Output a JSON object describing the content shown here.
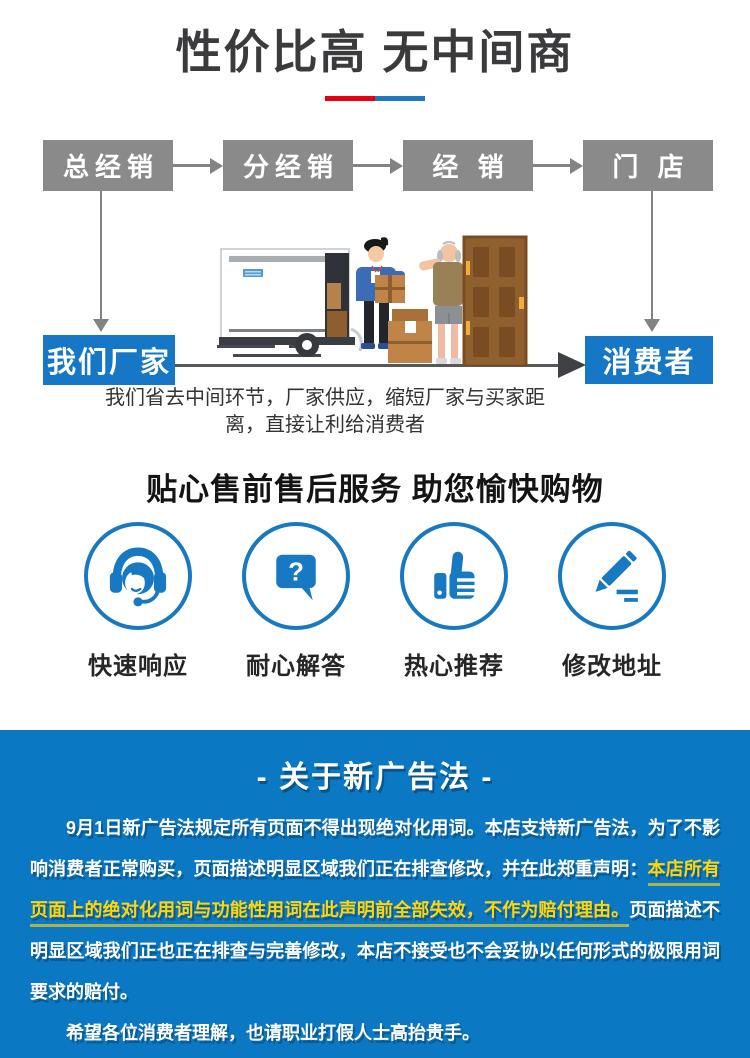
{
  "hero": {
    "title": "性价比高 无中间商"
  },
  "colors": {
    "accent_blue": "#1577c5",
    "notice_background": "#0b78c3",
    "highlight_yellow": "#ffd60a",
    "underline_red": "#e60012",
    "underline_blue": "#1f78c0",
    "flow_box_gray": "#8a8a8a"
  },
  "flow": {
    "top_boxes": [
      "总经销",
      "分经销",
      "经 销",
      "门 店"
    ],
    "bottom_left": "我们厂家",
    "bottom_right": "消费者",
    "caption": "我们省去中间环节，厂家供应，缩短厂家与买家距离，直接让利给消费者"
  },
  "services": {
    "title": "贴心售前售后服务 助您愉快购物",
    "items": [
      {
        "icon": "headset-icon",
        "label": "快速响应"
      },
      {
        "icon": "question-bubble-icon",
        "label": "耐心解答"
      },
      {
        "icon": "thumbs-up-icon",
        "label": "热心推荐"
      },
      {
        "icon": "pencil-icon",
        "label": "修改地址"
      }
    ]
  },
  "notice": {
    "heading": "- 关于新广告法 -",
    "paragraphs": [
      {
        "segments": [
          {
            "text": "9月1日新广告法规定所有页面不得出现绝对化用词。本店支持新广告法，为了不影响消费者正常购买，页面描述明显区域我们正在排查修改，并在此郑重声明：",
            "emphasis": false
          },
          {
            "text": "本店所有页面上的绝对化用词与功能性用词在此声明前全部失效，不作为赔付理由。",
            "emphasis": true
          },
          {
            "text": "页面描述不明显区域我们正也正在排查与完善修改，本店不接受也不会妥协以任何形式的极限用词要求的赔付。",
            "emphasis": false
          }
        ]
      },
      {
        "segments": [
          {
            "text": "希望各位消费者理解，也请职业打假人士高抬贵手。",
            "emphasis": false
          }
        ]
      }
    ]
  }
}
